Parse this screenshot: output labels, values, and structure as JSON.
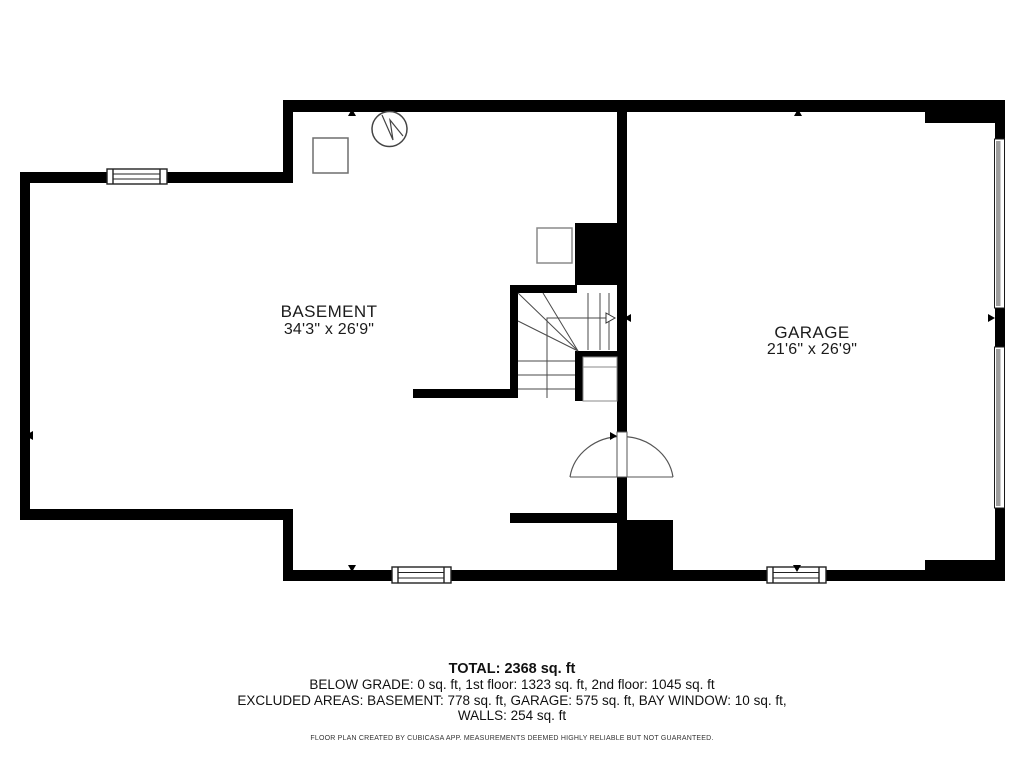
{
  "floor_plan": {
    "level": "basement-and-garage",
    "rooms": [
      {
        "name": "BASEMENT",
        "dimensions": "34'3\" x 26'9\""
      },
      {
        "name": "GARAGE",
        "dimensions": "21'6\" x 26'9\""
      }
    ],
    "features": {
      "windows": 3,
      "garage_doors": 2,
      "stairs": "u-shaped with winder treads and up-arrow walk line",
      "door": "swing-arc door in wall between basement and garage",
      "icons": [
        "water-heater-circle-icon",
        "appliance-square-icon",
        "appliance-square-icon"
      ]
    }
  },
  "summary": {
    "total": "TOTAL: 2368 sq. ft",
    "grade_line": "BELOW GRADE: 0 sq. ft, 1st floor: 1323 sq. ft, 2nd floor: 1045 sq. ft",
    "excluded_line": "EXCLUDED AREAS: BASEMENT: 778 sq. ft, GARAGE: 575 sq. ft, BAY WINDOW: 10 sq. ft,",
    "walls_line": "WALLS: 254 sq. ft"
  },
  "footer": {
    "disclaimer": "FLOOR PLAN CREATED BY CUBICASA APP. MEASUREMENTS DEEMED HIGHLY RELIABLE BUT NOT GUARANTEED."
  },
  "colors": {
    "wall": "#000000",
    "background": "#ffffff",
    "garage_door_gray": "#9d9d9d",
    "thin_line": "#4a4a4a",
    "light_gray": "#8a8a8a"
  }
}
